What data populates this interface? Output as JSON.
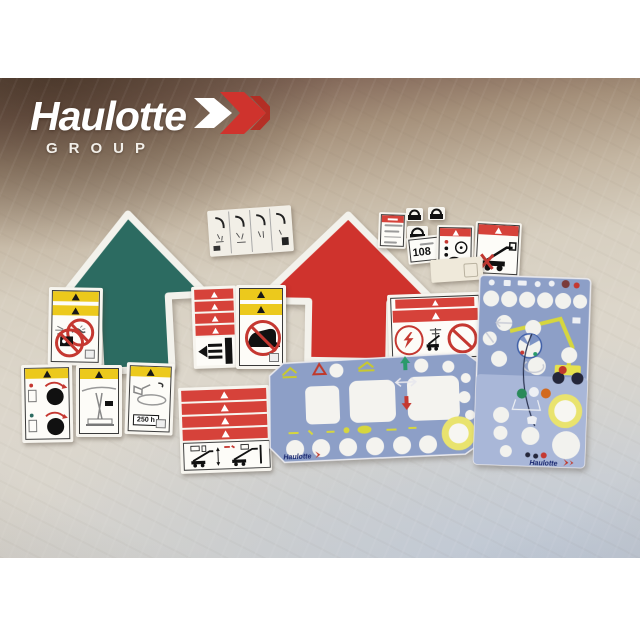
{
  "brand": {
    "name": "Haulotte",
    "subtitle": "GROUP"
  },
  "labels": {
    "number": "108",
    "hours": "250 h"
  },
  "panels": {
    "control_logo": "Haulotte",
    "right_logo": "Haulotte"
  },
  "colors": {
    "green_arrow": "#2c6b61",
    "red_arrow": "#cf332d",
    "warning_red_band": "#d6423a",
    "warning_yellow_band": "#ecc91c",
    "prohibition_red": "#c53831",
    "panel_blue": "#8d9fc7",
    "panel_blue_light": "#a9b7d8",
    "panel_yellow_ring": "#e9e36e",
    "fabric_light": "#dcd6ca",
    "fabric_shadow_brown": "#6e5848"
  }
}
